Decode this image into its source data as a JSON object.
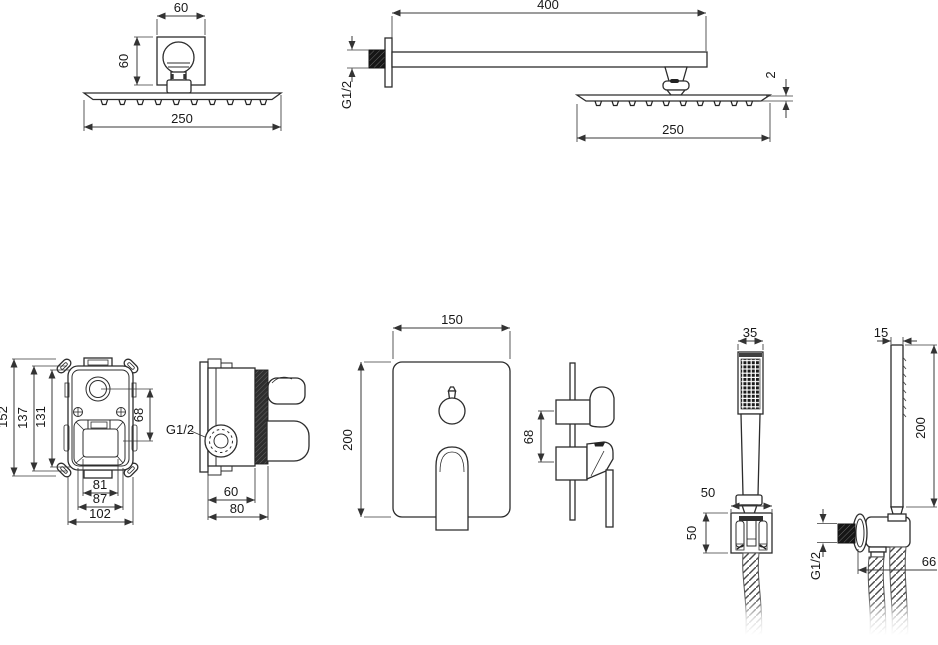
{
  "colors": {
    "line": "#2c2c2c",
    "dimension": "#3a3a3a",
    "dark_fill": "#1a1a1a"
  },
  "views": {
    "overhead_front": {
      "mount_width": "60",
      "mount_depth": "60",
      "head_width": "250"
    },
    "overhead_side": {
      "arm_length": "400",
      "connection_thread": "G1/2",
      "head_thickness": "2",
      "head_width": "250"
    },
    "valve_front": {
      "overall_height": "152",
      "housing_height": "137",
      "body_height": "131",
      "center_spacing": "68",
      "opening_width": "81",
      "housing_width": "87",
      "body_width": "102"
    },
    "valve_side": {
      "connection_thread": "G1/2",
      "body_depth": "60",
      "overall_depth": "80"
    },
    "trim_front": {
      "plate_width": "150",
      "plate_height": "200"
    },
    "trim_side": {
      "control_spacing": "68"
    },
    "hand_front": {
      "head_width": "35",
      "holder_width": "50",
      "holder_height": "50"
    },
    "hand_side": {
      "wand_width": "15",
      "wand_length": "200",
      "connection_thread": "G1/2",
      "outlet_width": "66"
    }
  }
}
